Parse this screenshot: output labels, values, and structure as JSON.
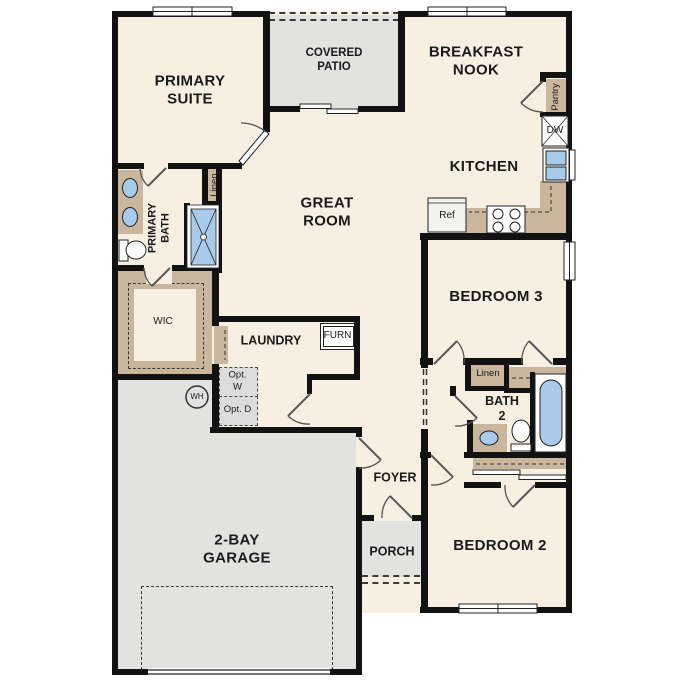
{
  "plan_title": "single-story floor plan",
  "rooms": {
    "primary_suite": "PRIMARY SUITE",
    "covered_patio": "COVERED PATIO",
    "breakfast_nook": "BREAKFAST NOOK",
    "kitchen": "KITCHEN",
    "great_room": "GREAT ROOM",
    "primary_bath": "PRIMARY BATH",
    "wic": "WIC",
    "laundry": "LAUNDRY",
    "bedroom3": "BEDROOM 3",
    "bath2": "BATH 2",
    "bedroom2": "BEDROOM 2",
    "foyer": "FOYER",
    "porch": "PORCH",
    "garage": "2-BAY GARAGE"
  },
  "fixtures": {
    "linen_primary": "Linen",
    "linen_hall": "Linen",
    "pantry": "Pantry",
    "dishwasher": "DW",
    "refrigerator": "Ref",
    "furnace": "FURN",
    "water_heater": "WH",
    "optional_washer": "Opt. W",
    "optional_dryer": "Opt. D"
  },
  "palette": {
    "wall": "#121212",
    "floor": "#f7efe1",
    "outdoor_gray": "#e2e2e0",
    "cabinet_tan": "#c9b69c",
    "fixture_blue": "#a9cbea",
    "option_gray": "#dcdcdc"
  }
}
